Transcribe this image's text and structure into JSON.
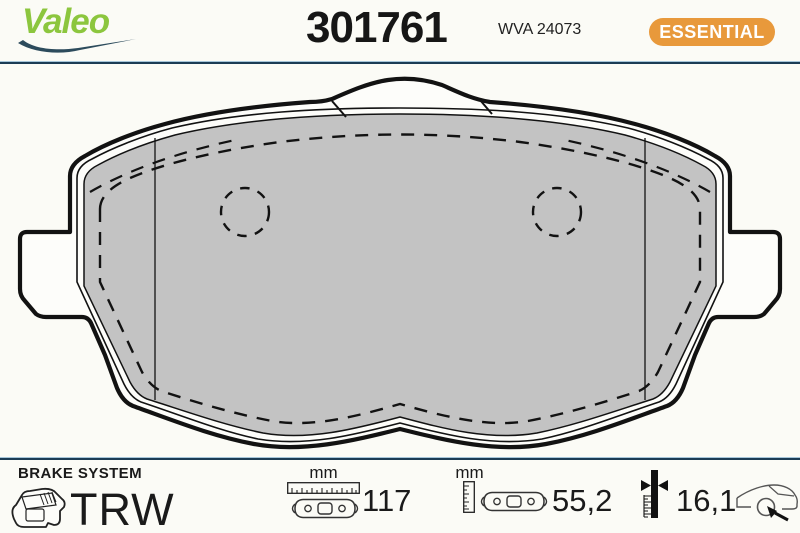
{
  "header": {
    "brand_logo": "Valeo",
    "part_number": "301761",
    "wva_number": "WVA 24073",
    "range_badge": "ESSENTIAL"
  },
  "colors": {
    "badge_orange": "#E8993B",
    "valeo_green": "#8CC63E",
    "swoosh_navy": "#2C4B5C",
    "divider_navy": "#1B3C55",
    "pad_gray": "#C3C3C3"
  },
  "footer": {
    "brake_system_label": "BRAKE SYSTEM",
    "oe_supplier": "TRW",
    "measurements": [
      {
        "unit": "mm",
        "value": "117"
      },
      {
        "unit": "mm",
        "value": "55,2"
      },
      {
        "unit": "",
        "value": "16,1"
      }
    ]
  }
}
